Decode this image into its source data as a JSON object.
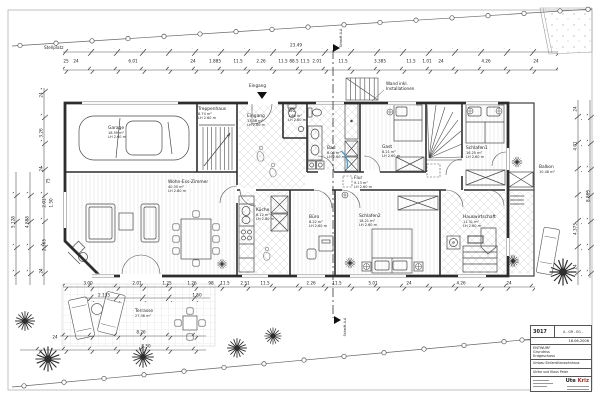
{
  "labels": {
    "stellplatz": "Stellplatz",
    "eingang_entry": "Eingang",
    "wand_line1": "Wand inkl.",
    "wand_line2": "Installationen",
    "schnitt": "Schnitt A-A",
    "total_width": "23.49"
  },
  "rooms": {
    "garage": {
      "name": "Garage",
      "area": "18.59 m²",
      "height": "LH 2.60 m"
    },
    "treppenhaus": {
      "name": "Treppenhaus",
      "area": "8.74 m²",
      "height": "LH 2.60 m"
    },
    "eingang": {
      "name": "Eingang",
      "area": "13.58 m²",
      "height": "LH 2.60 m"
    },
    "wc": {
      "name": "WC",
      "area": "1.60 m²",
      "height": "LH 2.60 m"
    },
    "bad": {
      "name": "Bad",
      "area": "6.05 m²",
      "height": "LH 2.60 m"
    },
    "gast": {
      "name": "Gast",
      "area": "8.21 m²",
      "height": "LH 2.60 m"
    },
    "schlafen1": {
      "name": "Schlafen1",
      "area": "16.25 m²",
      "height": "LH 2.60 m"
    },
    "balkon": {
      "name": "Balkon",
      "area": "10.48 m²"
    },
    "flur": {
      "name": "Flur",
      "area": "9.13 m²",
      "height": "LH 2.60 m"
    },
    "wohnen": {
      "name": "Wohn-Ess-Zimmer",
      "area": "40.35 m²",
      "height": "LH 2.80 m"
    },
    "kueche": {
      "name": "Küche",
      "area": "6.12 m²",
      "height": "LH 2.80 m"
    },
    "buero": {
      "name": "Büro",
      "area": "8.22 m²",
      "height": "LH 2.60 m"
    },
    "schlafen2": {
      "name": "Schlafen2",
      "area": "18.21 m²",
      "height": "LH 2.60 m"
    },
    "hauswirtschaft": {
      "name": "Hauswirtschaft",
      "area": "11.31 m²",
      "height": "LH 2.60 m"
    },
    "terrasse": {
      "name": "Terrasse",
      "area": "27.36 m²"
    }
  },
  "dims": {
    "top": [
      "25",
      "24",
      "6.01",
      "24",
      "1.885",
      "11.5",
      "2.26",
      "11.5",
      "88.5",
      "11.5",
      "2.01",
      "11.5",
      "3.385",
      "11.5",
      "1.01",
      "24",
      "4.26",
      "24"
    ],
    "left": [
      "5.125",
      "4.885",
      "24",
      "3.26",
      "24",
      "75",
      "2.01",
      "1.50",
      "2.365",
      "24"
    ],
    "right": [
      "24",
      "4.01",
      "8.865",
      "4.375",
      "24"
    ],
    "bottom": [
      "3.00",
      "2.01",
      "1.25",
      "1.26",
      "98",
      "11.5",
      "2.51",
      "11.5",
      "2.26",
      "11.5",
      "5.01",
      "24",
      "4.26",
      "24"
    ],
    "bottom2": [
      "2.135",
      "1.50"
    ],
    "terrace1": "8.26",
    "terrace2": "8.50",
    "terrace_left": "24"
  },
  "titleblock": {
    "number": "3017",
    "code": "A - GR - EG -",
    "date": "18.06.2006",
    "phase": "ENTWURF",
    "doc1": "Grundriss",
    "doc2": "Erdgeschoss",
    "project": "Umbau Einfamilienwohnhaus",
    "client": "Ulrike und Klaus Peter",
    "firm1": "Ute",
    "firm2": "Kriz"
  }
}
